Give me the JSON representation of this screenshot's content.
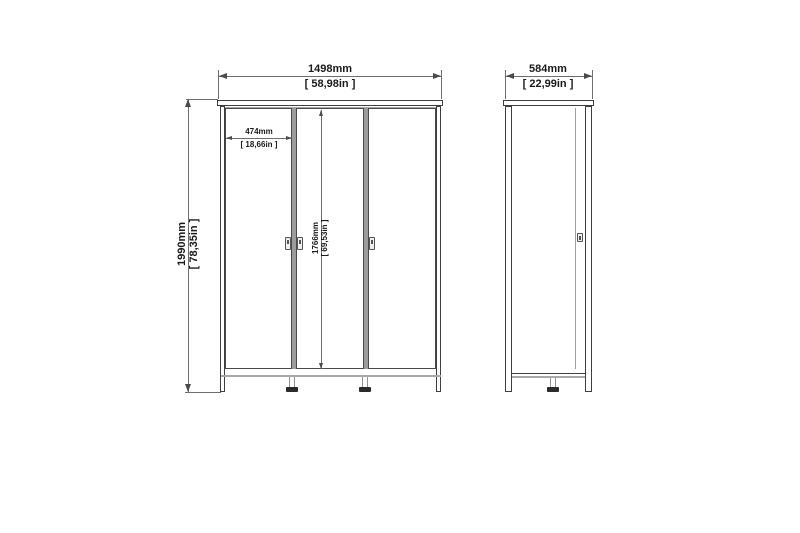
{
  "title": "wardrobe-dimension-diagram",
  "front_view": {
    "width_mm": "1498mm",
    "width_in": "[ 58,98in ]",
    "height_mm": "1990mm",
    "height_in": "[ 78,35in ]",
    "door_width_mm": "474mm",
    "door_width_in": "[ 18,66in ]",
    "door_height_mm": "1766mm",
    "door_height_in": "[ 69,53in ]"
  },
  "side_view": {
    "depth_mm": "584mm",
    "depth_in": "[ 22,99in ]"
  },
  "colors": {
    "background": "#ffffff",
    "outline": "#3f3f3f",
    "dimension_line": "#6e6e6e",
    "light_line": "#a8a8a8",
    "divider": "#9c9c9c",
    "foot_cap": "#2b2b2b",
    "text": "#1a1a1a"
  }
}
